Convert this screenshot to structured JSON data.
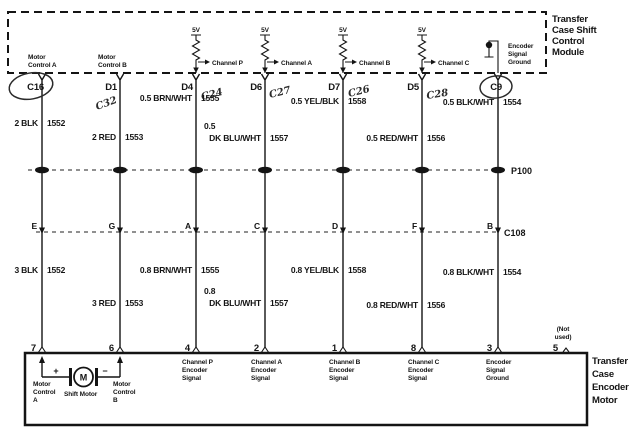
{
  "colors": {
    "ink": "#141414",
    "pen": "#2a2a2a",
    "background": "#ffffff"
  },
  "title_module": [
    "Transfer",
    "Case Shift",
    "Control",
    "Module"
  ],
  "title_motor": [
    "Transfer",
    "Case",
    "Encoder",
    "Motor"
  ],
  "supply_voltage": "5V",
  "connectors": {
    "p100": "P100",
    "c108": "C108"
  },
  "pin5": {
    "number": "5",
    "label": [
      "(Not",
      "used)"
    ]
  },
  "motor": {
    "plus": "+",
    "minus": "−",
    "symbol": "M",
    "shift_label": "Shift Motor",
    "control_a": [
      "Motor",
      "Control",
      "A"
    ],
    "control_b": [
      "Motor",
      "Control",
      "B"
    ]
  },
  "wires": [
    {
      "top_pin": "C16",
      "module_label": [
        "Motor",
        "Control A"
      ],
      "upper_label": "2 BLK",
      "upper_circuit": "1552",
      "c108_pin": "E",
      "lower_label": "3 BLK",
      "lower_circuit": "1552",
      "bottom_pin": "7"
    },
    {
      "top_pin": "D1",
      "note": "C32",
      "module_label": [
        "Motor",
        "Control B"
      ],
      "upper_label": "2 RED",
      "upper_circuit": "1553",
      "c108_pin": "G",
      "lower_label": "3 RED",
      "lower_circuit": "1553",
      "bottom_pin": "6"
    },
    {
      "top_pin": "D4",
      "note": "C24",
      "channel": "Channel P",
      "upper_label": "0.5 BRN/WHT",
      "upper_circuit": "1555",
      "c108_pin": "A",
      "lower_label": "0.8 BRN/WHT",
      "lower_circuit": "1555",
      "bottom_pin": "4",
      "bottom_label": [
        "Channel P",
        "Encoder",
        "Signal"
      ]
    },
    {
      "top_pin": "D6",
      "note": "C27",
      "channel": "Channel A",
      "upper_label": "0.5",
      "upper_label2": "DK BLU/WHT",
      "upper_circuit": "1557",
      "c108_pin": "C",
      "lower_label": "0.8",
      "lower_label2": "DK BLU/WHT",
      "lower_circuit": "1557",
      "bottom_pin": "2",
      "bottom_label": [
        "Channel A",
        "Encoder",
        "Signal"
      ]
    },
    {
      "top_pin": "D7",
      "note": "C26",
      "channel": "Channel B",
      "upper_label": "0.5 YEL/BLK",
      "upper_circuit": "1558",
      "c108_pin": "D",
      "lower_label": "0.8 YEL/BLK",
      "lower_circuit": "1558",
      "bottom_pin": "1",
      "bottom_label": [
        "Channel B",
        "Encoder",
        "Signal"
      ]
    },
    {
      "top_pin": "D5",
      "note": "C28",
      "channel": "Channel C",
      "upper_label": "0.5 RED/WHT",
      "upper_circuit": "1556",
      "c108_pin": "F",
      "lower_label": "0.8 RED/WHT",
      "lower_circuit": "1556",
      "bottom_pin": "8",
      "bottom_label": [
        "Channel C",
        "Encoder",
        "Signal"
      ]
    },
    {
      "top_pin": "C9",
      "module_label": [
        "Encoder",
        "Signal",
        "Ground"
      ],
      "upper_label": "0.5 BLK/WHT",
      "upper_circuit": "1554",
      "c108_pin": "B",
      "lower_label": "0.8 BLK/WHT",
      "lower_circuit": "1554",
      "bottom_pin": "3",
      "bottom_label": [
        "Encoder",
        "Signal",
        "Ground"
      ]
    }
  ]
}
